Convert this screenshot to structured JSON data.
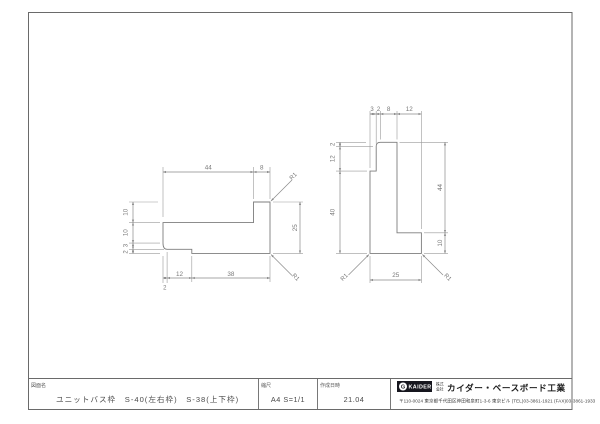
{
  "title_block": {
    "name_label": "図面名",
    "name_value": "ユニットバス枠　S-40(左右枠)　S-38(上下枠)",
    "scale_label": "縮尺",
    "scale_value": "A4 S=1/1",
    "date_label": "作成日時",
    "date_value": "21.04",
    "company": {
      "logo_mark": "G",
      "logo_text": "KAIDER",
      "corp_prefix_top": "株式",
      "corp_prefix_bottom": "会社",
      "name": "カイダー・ベースボード工業",
      "address": "〒110-0024 東京都千代田区神田和泉町1-3-6 東京ビル (TEL)03-3861-1921 (FAX)03-3861-1933"
    }
  },
  "drawing": {
    "left_profile": {
      "dim_top_1": "44",
      "dim_top_2": "8",
      "dim_left_1": "10",
      "dim_left_2": "10",
      "dim_left_3": "3",
      "dim_left_4": "2",
      "dim_right_1": "25",
      "dim_bottom_tiny": "2",
      "dim_bottom_1": "12",
      "dim_bottom_2": "38",
      "radius_top_right": "R1",
      "radius_bottom_right": "R1"
    },
    "right_profile": {
      "dim_top_1": "3",
      "dim_top_2": "2",
      "dim_top_3": "8",
      "dim_top_4": "12",
      "dim_left_1": "2",
      "dim_left_2": "12",
      "dim_left_3": "40",
      "dim_right_1": "44",
      "dim_right_2": "10",
      "dim_bottom_1": "25",
      "radius_bottom_left": "R1",
      "radius_bottom_right": "R1"
    }
  }
}
